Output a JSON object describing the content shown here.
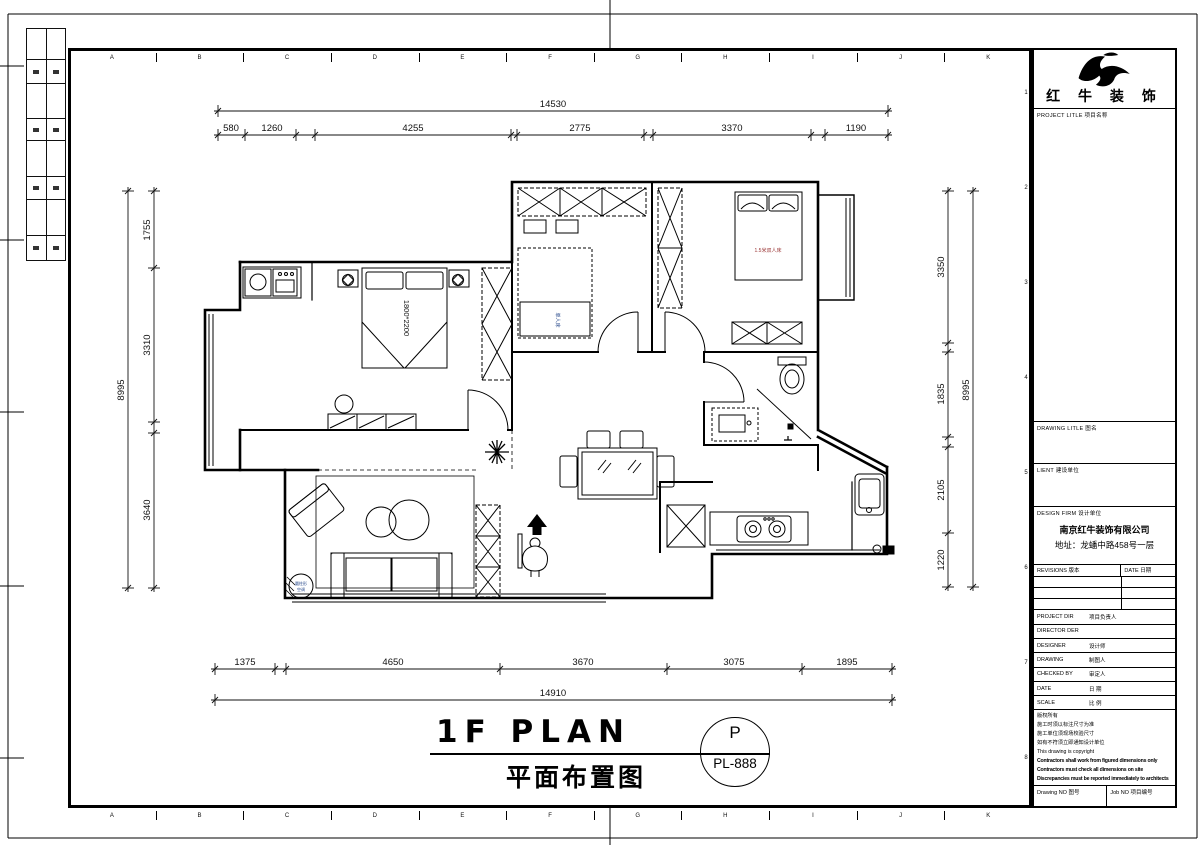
{
  "sheet": {
    "grid_letters": [
      "A",
      "B",
      "C",
      "D",
      "E",
      "F",
      "G",
      "H",
      "I",
      "J",
      "K"
    ],
    "grid_numbers": [
      "1",
      "2",
      "3",
      "4",
      "5",
      "6",
      "7",
      "8"
    ]
  },
  "plan_title": {
    "en": "1F PLAN",
    "cn": "平面布置图",
    "stamp_top": "P",
    "stamp_bottom": "PL-888"
  },
  "labels": {
    "master_bed_size": "1800*2200",
    "bed_15m": "1.5米双人床",
    "single_bed": "单人床",
    "ac_line1": "圆柱形",
    "ac_line2": "空调"
  },
  "dimensions": {
    "top_total": "14530",
    "top_segments": [
      "580",
      "1260",
      "4255",
      "2775",
      "3370",
      "1190"
    ],
    "bottom_segments": [
      "1375",
      "4650",
      "3670",
      "3075",
      "1895"
    ],
    "bottom_total": "14910",
    "left_total": "8995",
    "left_segments": [
      "1755",
      "3310",
      "3640"
    ],
    "right_segments": [
      "3350",
      "1835",
      "2105",
      "1220"
    ],
    "right_total": "8995"
  },
  "titleblock": {
    "company_name": "红 牛 装 饰",
    "project_title_label": "PROJECT LITLE  项目名称",
    "drawing_title_label": "DRAWING LITLE  图名",
    "client_label": "LIENT  建设单位",
    "design_firm_label": "DESIGN FIRM  设计单位",
    "firm_name": "南京红牛装饰有限公司",
    "firm_address": "地址：龙蟠中路458号一层",
    "revisions_label": "REVISIONS 版本",
    "date_col_label": "DATE 日期",
    "rows": [
      {
        "en": "PROJECT DIR",
        "cn": "项目负责人"
      },
      {
        "en": "DIRECTOR DER",
        "cn": ""
      },
      {
        "en": "DESIGNER",
        "cn": "设计师"
      },
      {
        "en": "DRAWING",
        "cn": "制图人"
      },
      {
        "en": "CHECKED BY",
        "cn": "审定人"
      },
      {
        "en": "DATE",
        "cn": "日 期"
      },
      {
        "en": "SCALE",
        "cn": "比 例"
      }
    ],
    "notes": [
      "版权所有",
      "施工时须以标注尺寸为准",
      "施工单位须现场校验尺寸",
      "如有不符须立即通知设计单位",
      "This drawing is copyright",
      "Contractors shall work from figured dimensions only",
      "Contractors must check all dimensions on site",
      "Discrepancies must be reported immediately to architects"
    ],
    "drawing_no_label": "Drawing NO  图号",
    "job_no_label": "Job NO  项目编号"
  }
}
